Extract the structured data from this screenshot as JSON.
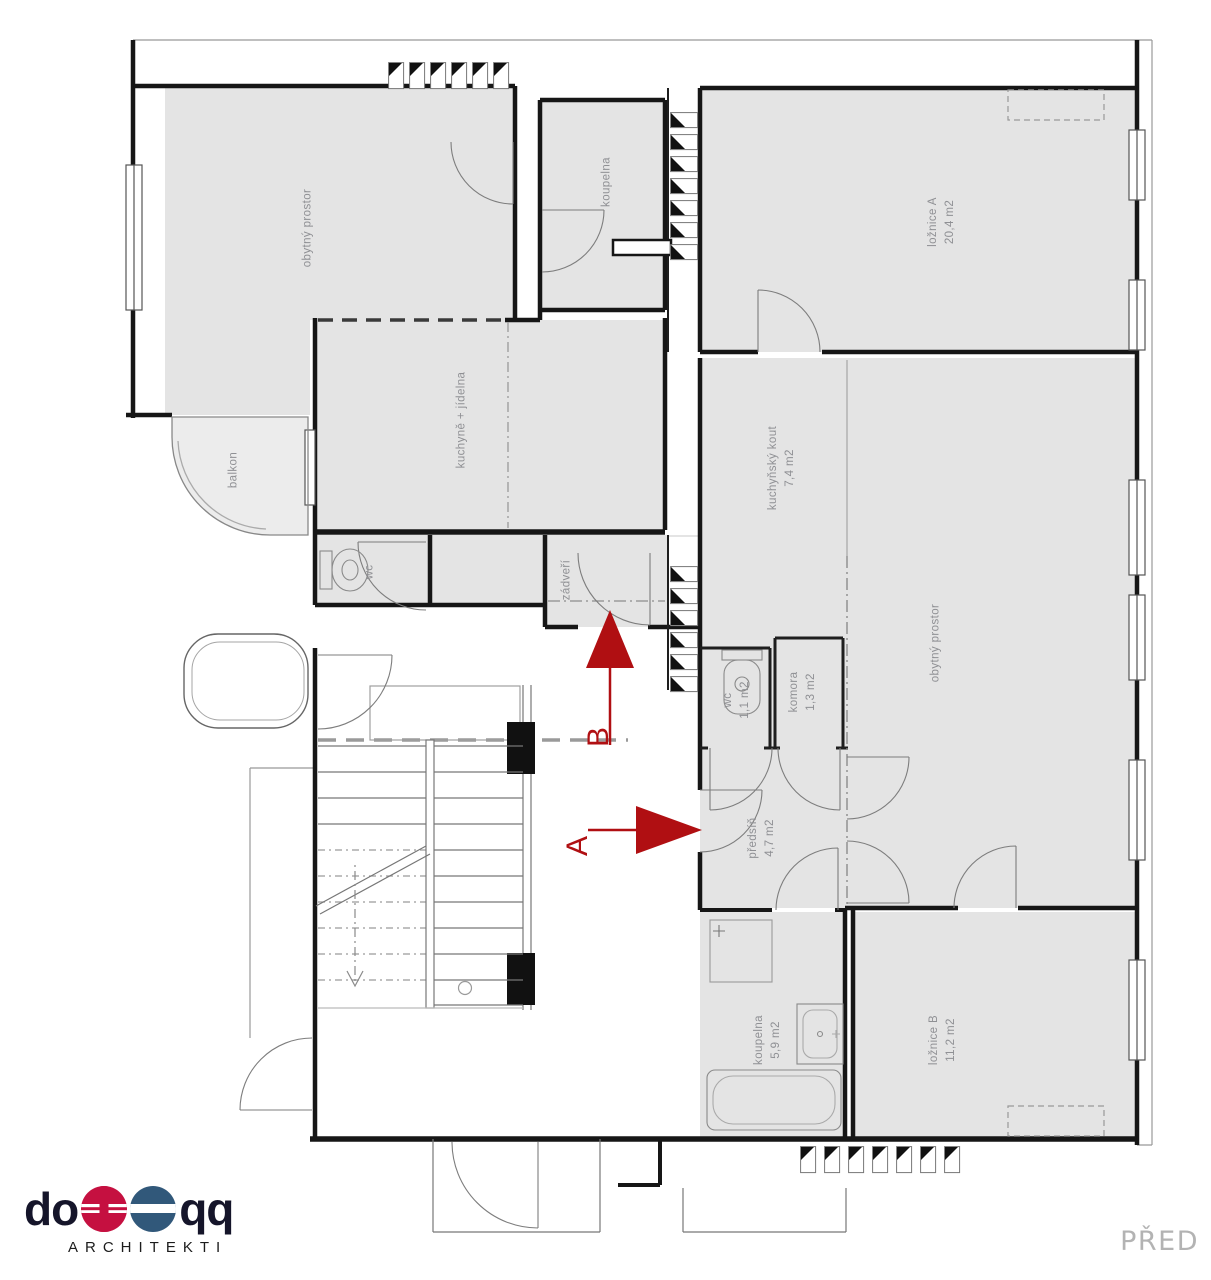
{
  "rooms": [
    {
      "label": "obytný prostor",
      "area": ""
    },
    {
      "label": "koupelna",
      "area": ""
    },
    {
      "label": "ložnice A",
      "area": "20,4 m2"
    },
    {
      "label": "kuchyně + jídelna",
      "area": ""
    },
    {
      "label": "balkon",
      "area": ""
    },
    {
      "label": "wc",
      "area": ""
    },
    {
      "label": "zádveří",
      "area": ""
    },
    {
      "label": "kuchyňský kout",
      "area": "7,4 m2"
    },
    {
      "label": "obytný prostor",
      "area": ""
    },
    {
      "label": "wc",
      "area": "1,1 m2"
    },
    {
      "label": "komora",
      "area": "1,3 m2"
    },
    {
      "label": "předsíň",
      "area": "4,7 m2"
    },
    {
      "label": "koupelna",
      "area": "5,9 m2"
    },
    {
      "label": "ložnice B",
      "area": "11,2 m2"
    }
  ],
  "sections": {
    "a": "A",
    "b": "B"
  },
  "logo": {
    "prefix": "do",
    "suffix": "qq",
    "subtitle": "ARCHITEKTI"
  },
  "footer": {
    "stage": "PŘED"
  },
  "colors": {
    "accent_red": "#b00f12",
    "logo_red": "#c51040",
    "logo_blue": "#31587a",
    "room_fill": "#e4e4e4",
    "balcony_fill": "#ececec",
    "wall": "#161616",
    "label_text": "#8f9094"
  }
}
